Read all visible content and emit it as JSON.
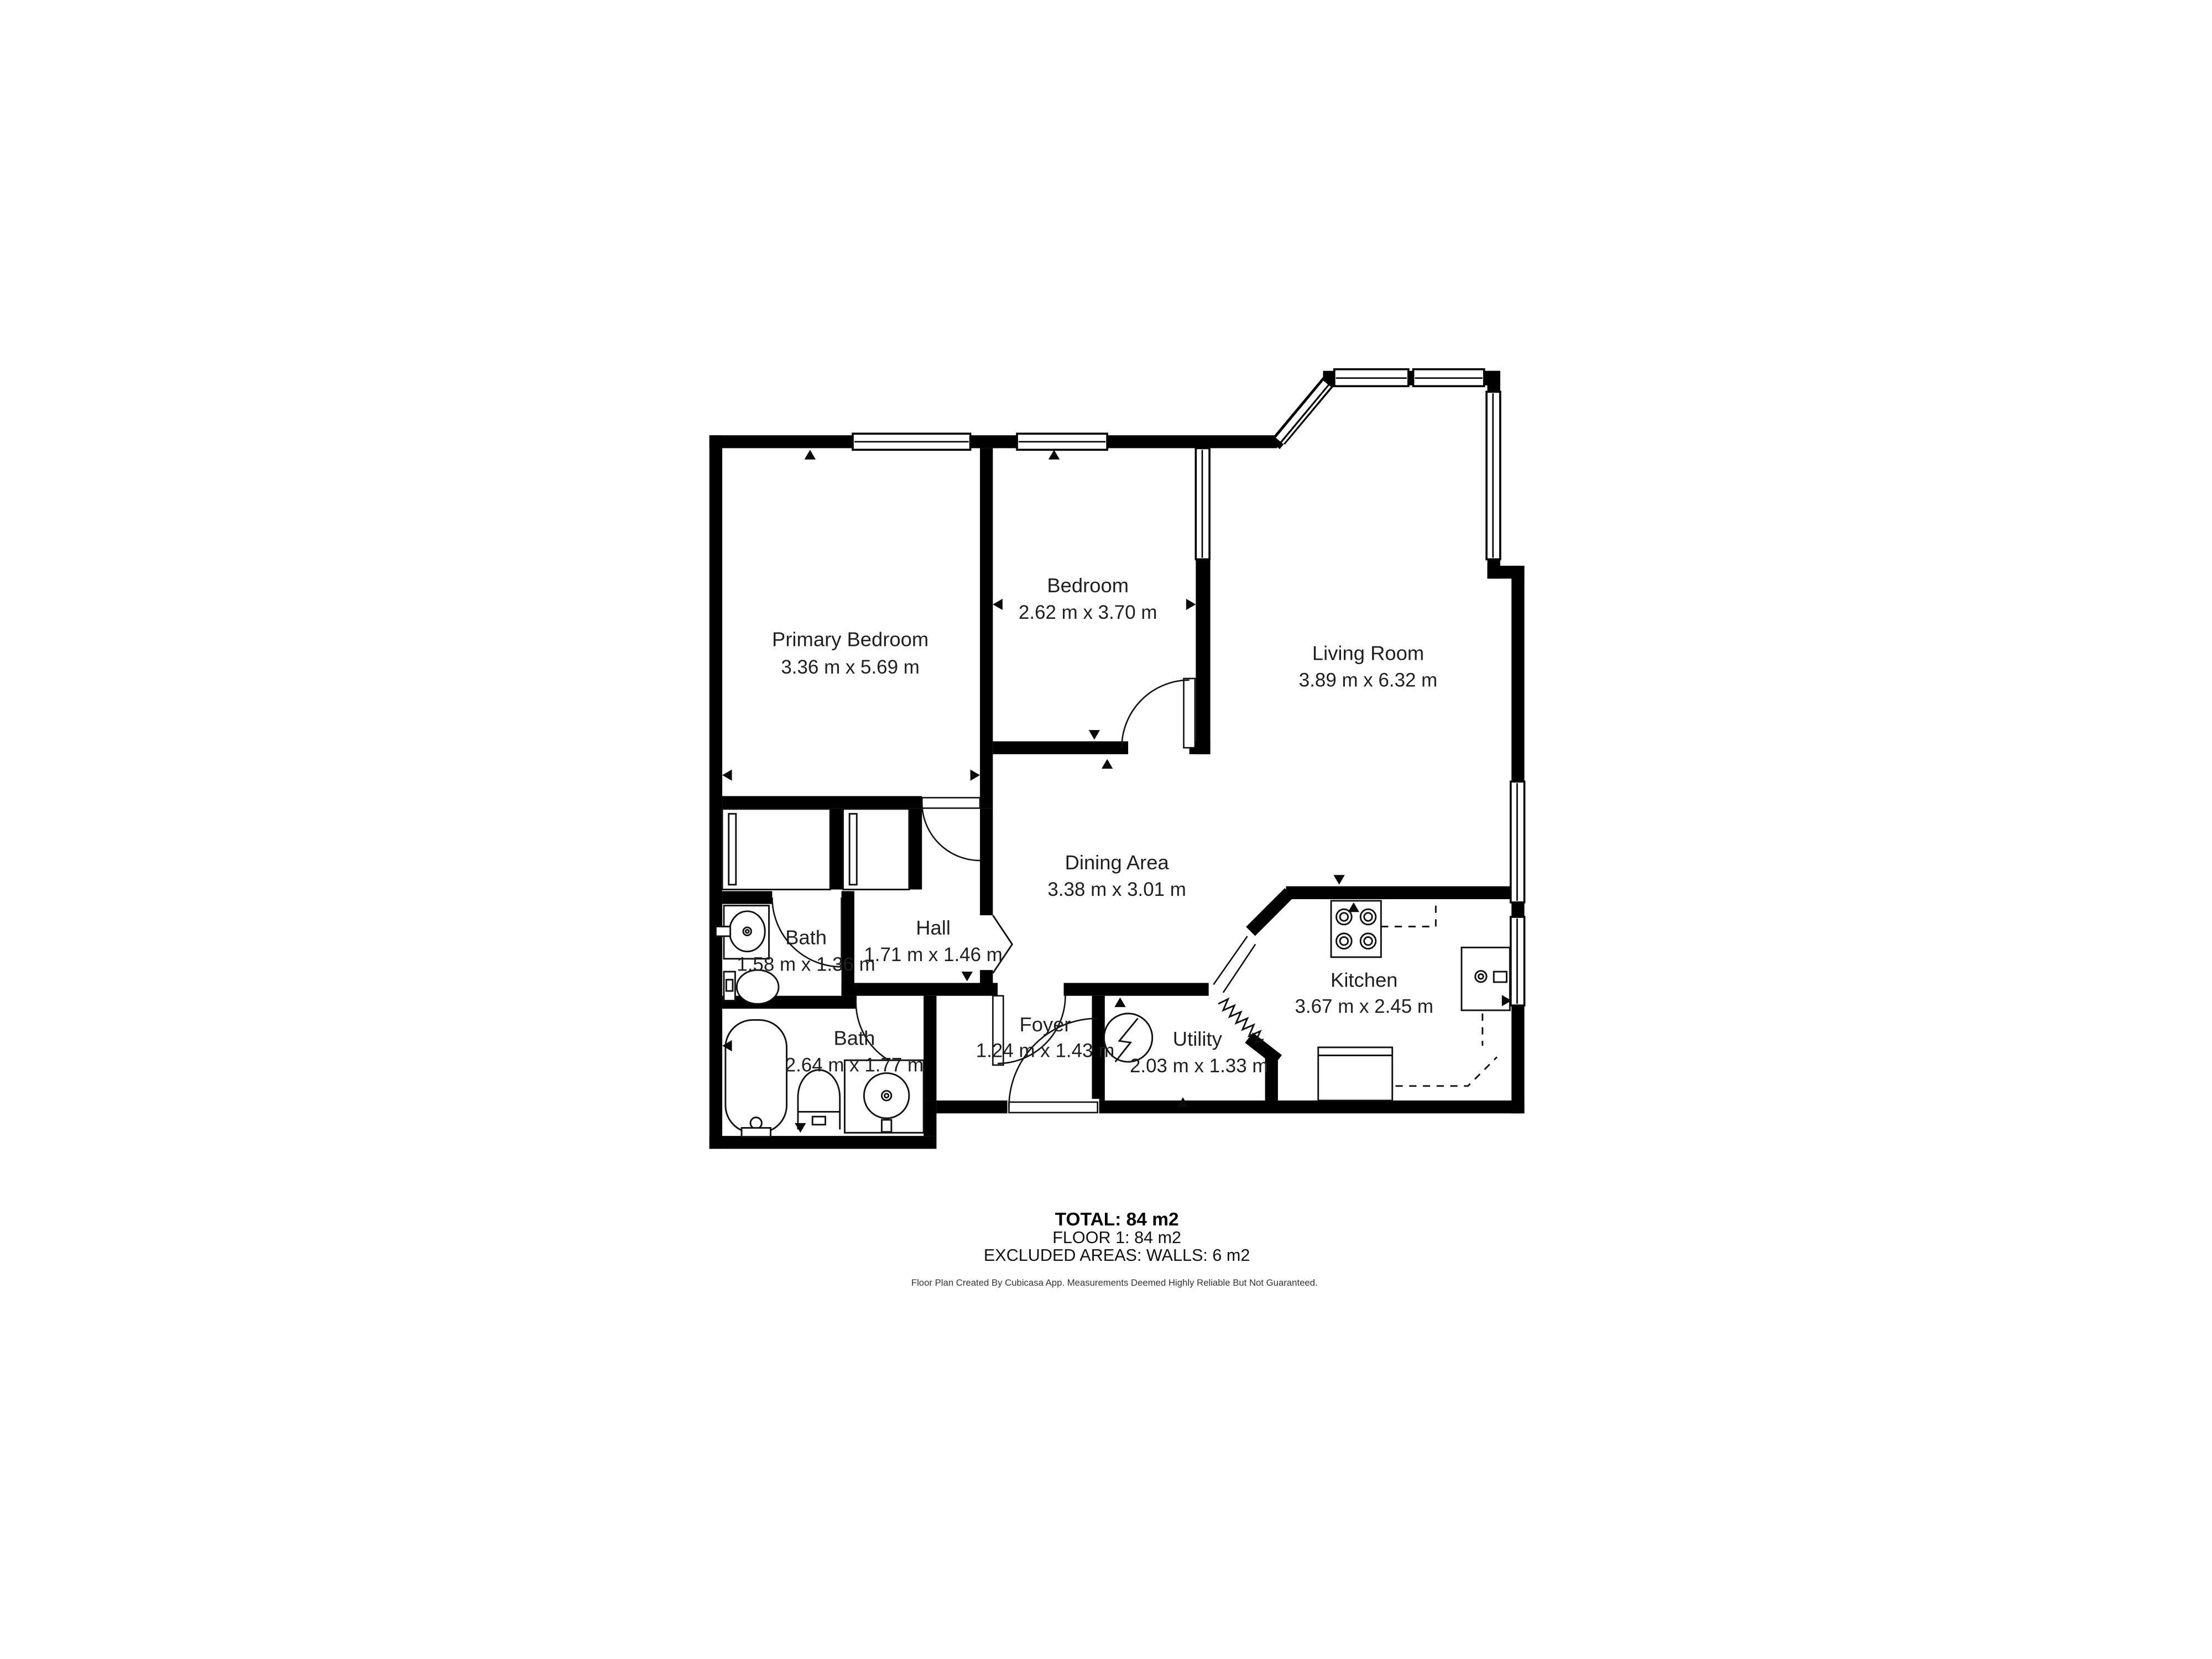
{
  "rooms": [
    {
      "name": "Primary Bedroom",
      "dims": "3.36 m x 5.69 m"
    },
    {
      "name": "Bedroom",
      "dims": "2.62 m x 3.70 m"
    },
    {
      "name": "Living Room",
      "dims": "3.89 m x 6.32 m"
    },
    {
      "name": "Dining Area",
      "dims": "3.38 m x 3.01 m"
    },
    {
      "name": "Hall",
      "dims": "1.71 m x 1.46 m"
    },
    {
      "name": "Bath",
      "dims": "1.58 m x 1.36 m"
    },
    {
      "name": "Bath",
      "dims": "2.64 m x 1.77 m"
    },
    {
      "name": "Foyer",
      "dims": "1.24 m x 1.43 m"
    },
    {
      "name": "Utility",
      "dims": "2.03 m x 1.33 m"
    },
    {
      "name": "Kitchen",
      "dims": "3.67 m x 2.45 m"
    }
  ],
  "summary": {
    "total": "TOTAL: 84 m2",
    "floor": "FLOOR 1: 84 m2",
    "excluded": "EXCLUDED AREAS: WALLS: 6 m2"
  },
  "footer": "Floor Plan Created By Cubicasa App. Measurements Deemed Highly Reliable But Not Guaranteed.",
  "colors": {
    "wall": "#000000",
    "background": "#ffffff",
    "text": "#1f1f1f"
  }
}
